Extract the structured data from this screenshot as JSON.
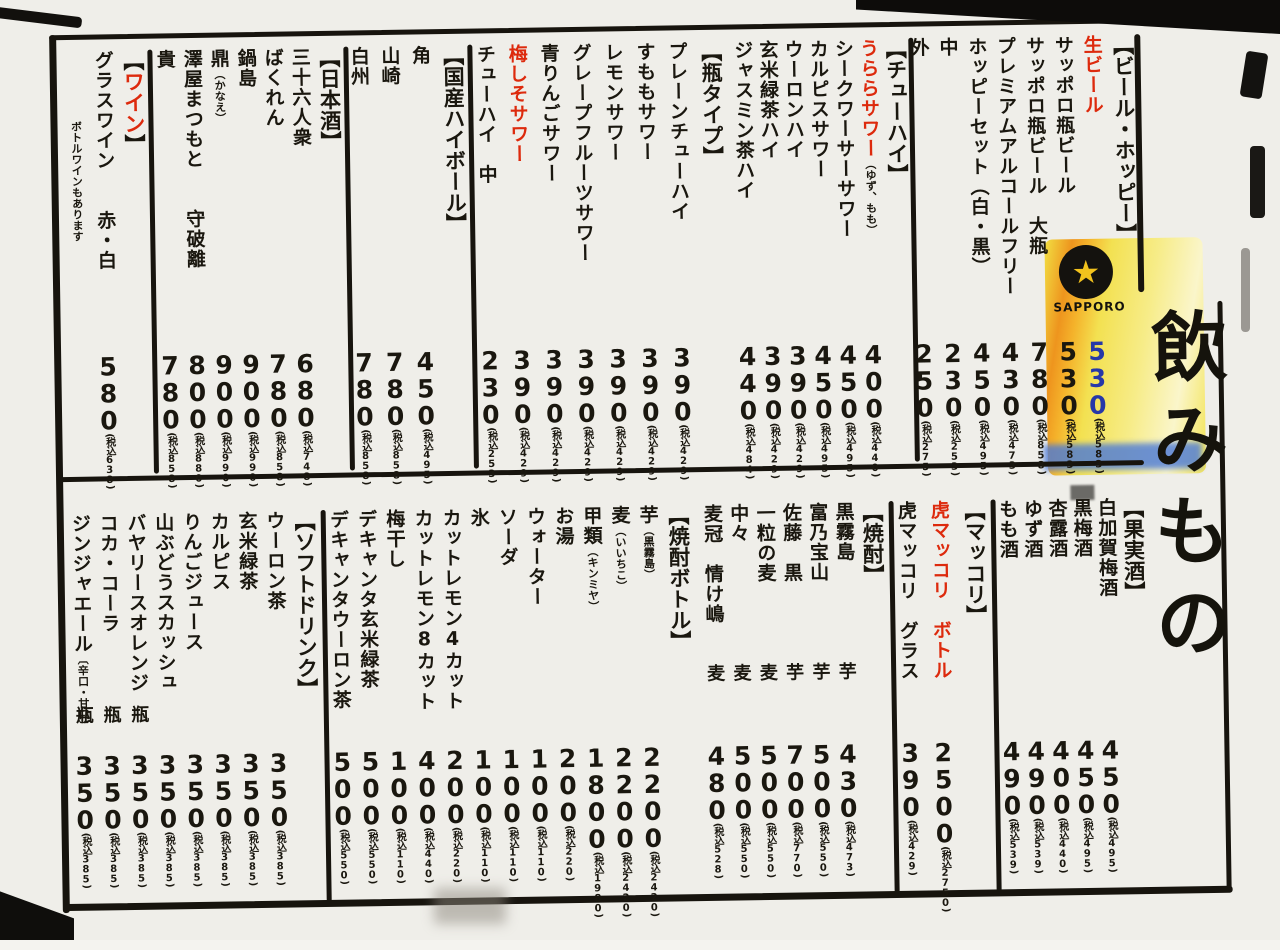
{
  "page_title": "飲みもの",
  "logo": {
    "name": "SAPPORO",
    "star": "★"
  },
  "glyphs": {
    "open": "【",
    "close": "】"
  },
  "colors": {
    "ink": "#1a170f",
    "red": "#dd2a0d",
    "blue": "#2638a8",
    "paper": "#efeee9",
    "highlight_orange": "#ee9013",
    "highlight_yellow": "#f3e34d"
  },
  "bands": {
    "top": {
      "sections": [
        {
          "id": "beer-hoppy",
          "header": {
            "label": "ビール・ホッピー"
          },
          "items": [
            {
              "name": "生ビール",
              "color": "red",
              "price": "530",
              "price_color": "blue",
              "tax": "(税込583)"
            },
            {
              "name": "サッポロ瓶ビール",
              "price": "530",
              "tax": "(税込583)"
            },
            {
              "name": "サッポロ瓶ビール　大瓶",
              "price": "780",
              "tax": "(税込858)"
            },
            {
              "name": "プレミアムアルコールフリー",
              "price": "430",
              "tax": "(税込473)"
            },
            {
              "name": "ホッピーセット（白・黒）",
              "price": "450",
              "tax": "(税込495)"
            },
            {
              "name": "中",
              "price": "230",
              "tax": "(税込253)"
            },
            {
              "name": "外",
              "price": "250",
              "tax": "(税込275)"
            }
          ]
        },
        {
          "id": "chuhai",
          "header": {
            "label": "チューハイ"
          },
          "items": [
            {
              "name": "うららサワー",
              "note": "（ゆず、もも）",
              "color": "red",
              "price": "400",
              "tax": "(税込440)"
            },
            {
              "name": "シークワーサーサワー",
              "price": "450",
              "tax": "(税込495)"
            },
            {
              "name": "カルピスサワー",
              "price": "450",
              "tax": "(税込495)"
            },
            {
              "name": "ウーロンハイ",
              "price": "390",
              "tax": "(税込429)"
            },
            {
              "name": "玄米緑茶ハイ",
              "price": "390",
              "tax": "(税込429)"
            },
            {
              "name": "ジャスミン茶ハイ",
              "price": "440",
              "tax": "(税込484)"
            }
          ]
        },
        {
          "id": "bin-type",
          "header": {
            "label": "瓶タイプ"
          },
          "items": [
            {
              "name": "プレーンチューハイ",
              "price": "390",
              "tax": "(税込429)"
            },
            {
              "name": "すももサワー",
              "price": "390",
              "tax": "(税込429)"
            },
            {
              "name": "レモンサワー",
              "price": "390",
              "tax": "(税込429)"
            },
            {
              "name": "グレープフルーツサワー",
              "price": "390",
              "tax": "(税込429)"
            },
            {
              "name": "青りんごサワー",
              "price": "390",
              "tax": "(税込429)"
            },
            {
              "name": "梅しそサワー",
              "color": "red",
              "price": "390",
              "tax": "(税込429)"
            },
            {
              "name": "チューハイ　中",
              "price": "230",
              "tax": "(税込253)"
            }
          ]
        },
        {
          "id": "kokusan-highball",
          "header": {
            "label": "国産ハイボール"
          },
          "items": [
            {
              "name": "角",
              "price": "450",
              "tax": "(税込495)"
            },
            {
              "name": "山崎",
              "price": "780",
              "tax": "(税込858)"
            },
            {
              "name": "白州",
              "price": "780",
              "tax": "(税込858)"
            }
          ]
        },
        {
          "id": "nihonshu",
          "header": {
            "label": "日本酒"
          },
          "items": [
            {
              "name": "三十六人衆",
              "price": "680",
              "tax": "(税込748)"
            },
            {
              "name": "ばくれん",
              "price": "780",
              "tax": "(税込858)"
            },
            {
              "name": "鍋島",
              "price": "900",
              "tax": "(税込990)"
            },
            {
              "name": "鼎",
              "note": "（かなえ）",
              "price": "900",
              "tax": "(税込990)"
            },
            {
              "name": "澤屋まつもと　　守破離",
              "price": "800",
              "tax": "(税込880)"
            },
            {
              "name": "貴",
              "price": "780",
              "tax": "(税込858)"
            }
          ]
        },
        {
          "id": "wine",
          "header": {
            "label": "ワイン",
            "color": "red"
          },
          "items": [
            {
              "name": "グラスワイン　　赤・白",
              "price": "580",
              "tax": "(税込638)"
            },
            {
              "name": "ボトルワインもあります",
              "small": true,
              "top": 70
            }
          ]
        }
      ]
    },
    "bottom": {
      "sections": [
        {
          "id": "kajitsushu",
          "header": {
            "label": "果実酒"
          },
          "items": [
            {
              "name": "白加賀梅酒",
              "price": "450",
              "tax": "(税込495)"
            },
            {
              "name": "黒梅酒",
              "price": "450",
              "tax": "(税込495)"
            },
            {
              "name": "杏露酒",
              "price": "400",
              "tax": "(税込440)"
            },
            {
              "name": "ゆず酒",
              "price": "490",
              "tax": "(税込539)"
            },
            {
              "name": "もも酒",
              "price": "490",
              "tax": "(税込539)"
            }
          ]
        },
        {
          "id": "makgeolli",
          "header": {
            "label": "マッコリ"
          },
          "items": [
            {
              "name": "虎マッコリ　ボトル",
              "color": "red",
              "price": "2500",
              "tax": "(税込2750)"
            },
            {
              "name": "虎マッコリ　グラス",
              "price": "390",
              "tax": "(税込429)"
            }
          ]
        },
        {
          "id": "shochu",
          "header": {
            "label": "焼酎"
          },
          "items": [
            {
              "name": "黒霧島",
              "marker": "芋",
              "price": "430",
              "tax": "(税込473)"
            },
            {
              "name": "富乃宝山",
              "marker": "芋",
              "price": "500",
              "tax": "(税込550)"
            },
            {
              "name": "佐藤　黒",
              "marker": "芋",
              "price": "700",
              "tax": "(税込770)"
            },
            {
              "name": "一粒の麦",
              "marker": "麦",
              "price": "500",
              "tax": "(税込550)"
            },
            {
              "name": "中々",
              "marker": "麦",
              "price": "500",
              "tax": "(税込550)"
            },
            {
              "name": "麦冠　情け嶋",
              "marker": "麦",
              "price": "480",
              "tax": "(税込528)"
            }
          ]
        },
        {
          "id": "shochu-bottle",
          "header": {
            "label": "焼酎ボトル"
          },
          "items": [
            {
              "name": "芋",
              "note": "（黒霧島）",
              "price": "2200",
              "tax": "(税込2420)"
            },
            {
              "name": "麦",
              "note": "（いいちこ）",
              "price": "2200",
              "tax": "(税込2420)"
            },
            {
              "name": "甲類",
              "note": "（キンミヤ）",
              "price": "1800",
              "tax": "(税込1980)"
            },
            {
              "name": "お湯",
              "price": "200",
              "tax": "(税込220)"
            },
            {
              "name": "ウォーター",
              "price": "100",
              "tax": "(税込110)"
            },
            {
              "name": "ソーダ",
              "price": "100",
              "tax": "(税込110)"
            },
            {
              "name": "氷",
              "price": "100",
              "tax": "(税込110)"
            },
            {
              "name": "カットレモン4カット",
              "price": "200",
              "tax": "(税込220)"
            },
            {
              "name": "カットレモン8カット",
              "price": "400",
              "tax": "(税込440)"
            },
            {
              "name": "梅干し",
              "price": "100",
              "tax": "(税込110)"
            },
            {
              "name": "デキャンタ玄米緑茶",
              "price": "500",
              "tax": "(税込550)"
            },
            {
              "name": "デキャンタウーロン茶",
              "price": "500",
              "tax": "(税込550)"
            }
          ]
        },
        {
          "id": "soft-drink",
          "header": {
            "label": "ソフトドリンク"
          },
          "items": [
            {
              "name": "ウーロン茶",
              "price": "350",
              "tax": "(税込385)"
            },
            {
              "name": "玄米緑茶",
              "price": "350",
              "tax": "(税込385)"
            },
            {
              "name": "カルピス",
              "price": "350",
              "tax": "(税込385)"
            },
            {
              "name": "りんごジュース",
              "price": "350",
              "tax": "(税込385)"
            },
            {
              "name": "山ぶどうスカッシュ",
              "price": "350",
              "tax": "(税込385)"
            },
            {
              "name": "バヤリースオレンジ",
              "marker": "瓶",
              "price": "350",
              "tax": "(税込385)"
            },
            {
              "name": "コカ・コーラ",
              "marker": "瓶",
              "price": "350",
              "tax": "(税込385)"
            },
            {
              "name": "ジンジャエール",
              "note": "〔辛口・甘口〕",
              "marker": "瓶",
              "price": "350",
              "tax": "(税込385)"
            }
          ]
        }
      ]
    }
  }
}
